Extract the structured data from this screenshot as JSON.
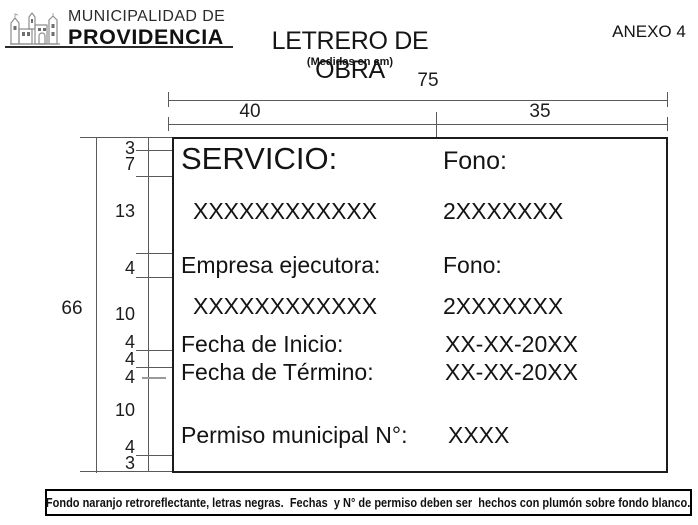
{
  "header": {
    "org_line1": "MUNICIPALIDAD DE",
    "org_line2": "PROVIDENCIA",
    "title": "LETRERO DE OBRA",
    "subtitle": "(Medidas en cm)",
    "annex": "ANEXO 4"
  },
  "diagram": {
    "top_total_width": "75",
    "top_width_left": "40",
    "top_width_right": "35",
    "left_total_height": "66",
    "left_segments": [
      "3",
      "7",
      "13",
      "4",
      "10",
      "4",
      "4",
      "4",
      "10",
      "4",
      "3"
    ]
  },
  "sign": {
    "rows": [
      {
        "left": "SERVICIO:",
        "right": "Fono:"
      },
      {
        "left": "XXXXXXXXXXXX",
        "right": "2XXXXXXX"
      },
      {
        "left": "Empresa ejecutora:",
        "right": "Fono:"
      },
      {
        "left": "XXXXXXXXXXXX",
        "right": "2XXXXXXX"
      },
      {
        "left": "Fecha de Inicio:",
        "right": "XX-XX-20XX"
      },
      {
        "left": "Fecha de Término:",
        "right": "XX-XX-20XX"
      },
      {
        "left": "Permiso municipal N°:",
        "right": "XXXX"
      }
    ]
  },
  "footnote": {
    "text": "Fondo naranjo retroreflectante, letras negras.  Fechas  y N° de permiso deben ser  hechos con plumón sobre fondo blanco."
  },
  "colors": {
    "ink": "#1a1a1a",
    "dimension_line": "#5a5a5a",
    "background": "#ffffff"
  }
}
